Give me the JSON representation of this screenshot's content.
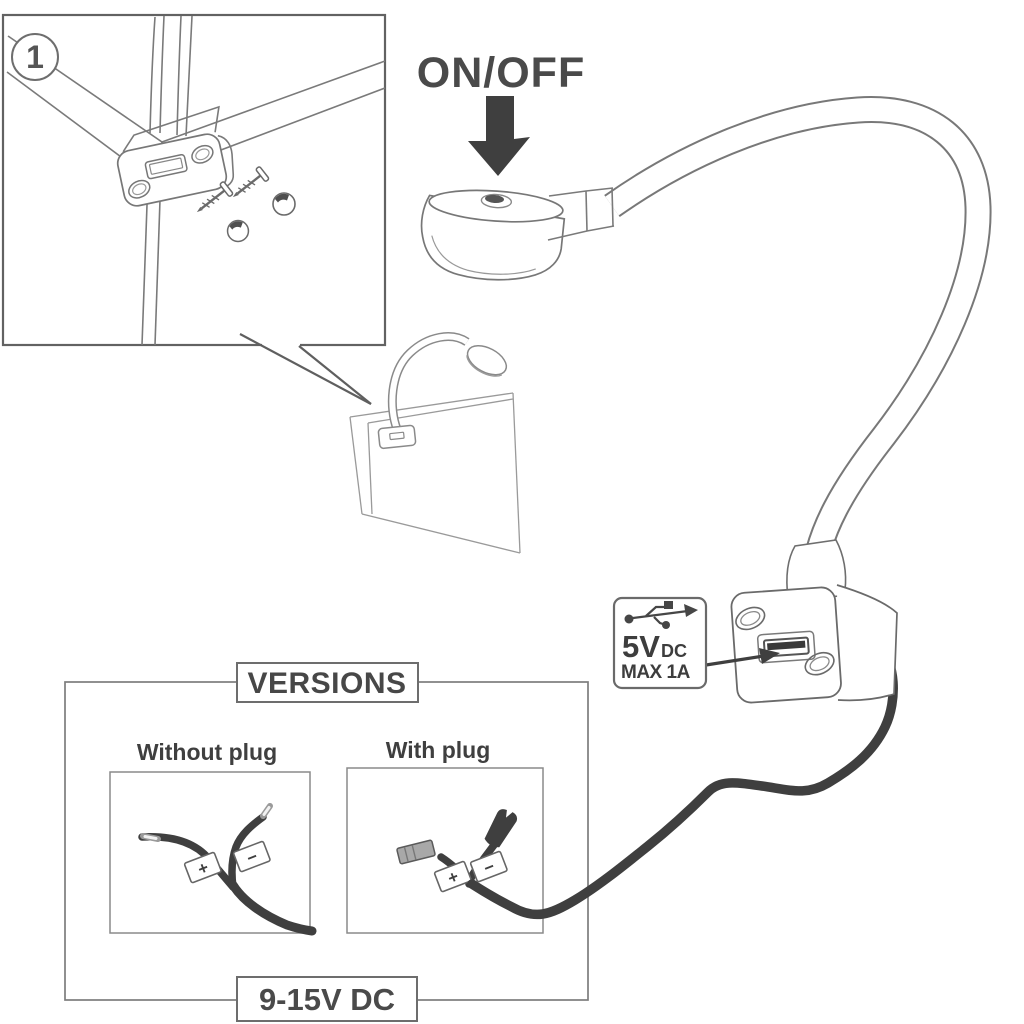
{
  "step_badge": "1",
  "on_off_label": "ON/OFF",
  "usb_output": {
    "volts": "5V",
    "unit": "DC",
    "max_current": "MAX 1A"
  },
  "versions": {
    "title": "VERSIONS",
    "without_plug_label": "Without plug",
    "with_plug_label": "With plug",
    "supply_range_label": "9-15V DC",
    "polarity_positive": "+",
    "polarity_negative": "−"
  },
  "icons": {
    "usb": "usb-trident-icon",
    "on_off_arrow": "arrow-down-icon",
    "usb_port_pointer": "arrow-right-icon",
    "callout_tail": "callout-pointer"
  },
  "colors": {
    "ink": "#3f3f3f",
    "line_art": "#757575",
    "cable": "#3f3f3f",
    "connector_gray": "#a8a8a8",
    "background": "#ffffff"
  }
}
